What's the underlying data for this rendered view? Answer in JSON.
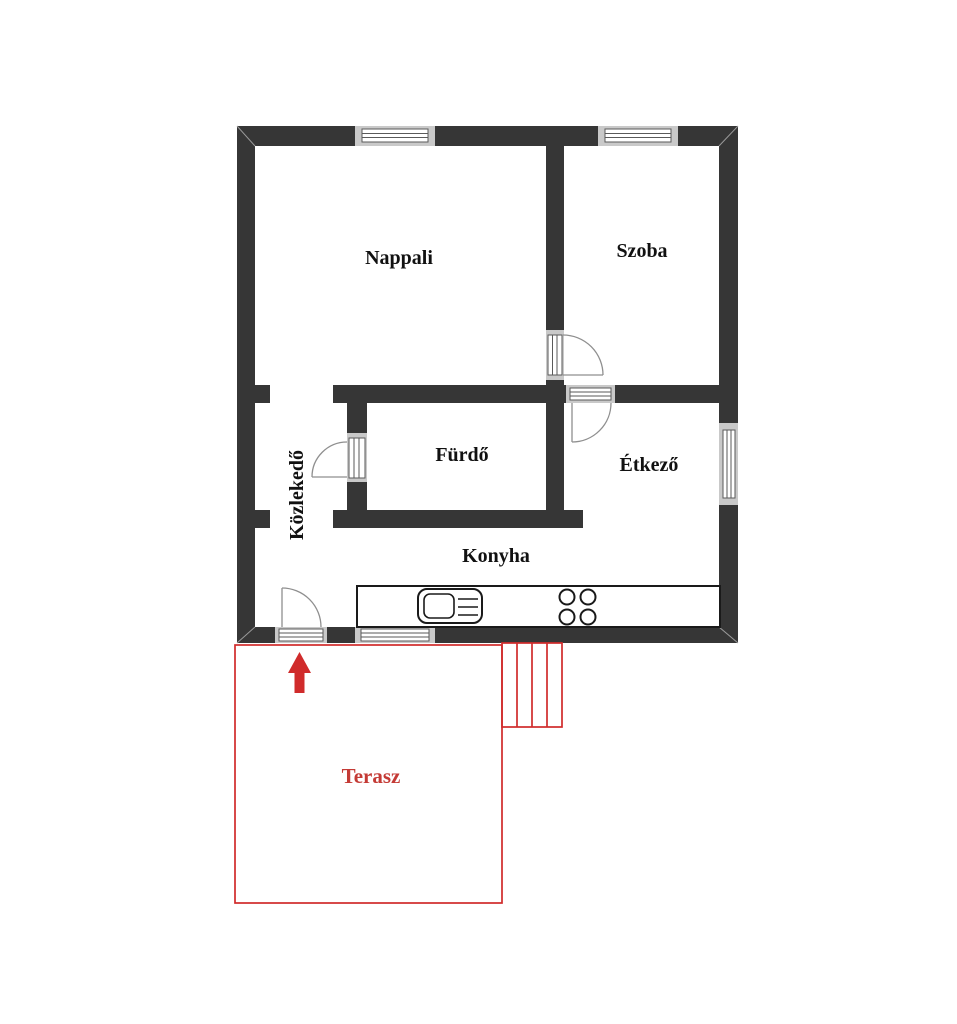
{
  "plan": {
    "rooms": [
      {
        "key": "nappali",
        "label": "Nappali"
      },
      {
        "key": "szoba",
        "label": "Szoba"
      },
      {
        "key": "furdo",
        "label": "Fürdő"
      },
      {
        "key": "etkezo",
        "label": "Étkező"
      },
      {
        "key": "konyha",
        "label": "Konyha"
      },
      {
        "key": "kozlekedo",
        "label": "Közlekedő"
      },
      {
        "key": "terasz",
        "label": "Terasz"
      }
    ],
    "colors": {
      "wall": "#363636",
      "accent_red": "#d02b2b",
      "label_black": "#111111",
      "opening_frame_gray": "#c9c9c9",
      "symbol_line_gray": "#8f8f8f"
    },
    "icons": [
      "window-icon",
      "door-swing-icon",
      "sink-icon",
      "stove-burners-icon",
      "stairs-icon",
      "entrance-arrow-icon"
    ]
  }
}
